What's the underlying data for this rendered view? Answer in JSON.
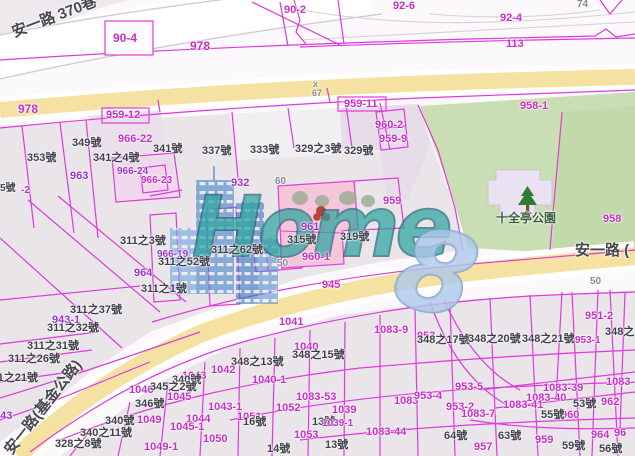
{
  "map": {
    "watermark": {
      "brand": "Home",
      "brand_suffix": "8"
    },
    "park_name": "十全亭公園",
    "roads": [
      "安一路 370巷",
      "安一路 (",
      "安一路(基金公路)"
    ],
    "labels": [
      {
        "t": "安一路 370巷",
        "x": 10,
        "y": 26,
        "c": "road",
        "s": 15,
        "r": -21
      },
      {
        "t": "安一路 (",
        "x": 575,
        "y": 243,
        "c": "road",
        "s": 15
      },
      {
        "t": "安一路(基金公路)",
        "x": 2,
        "y": 448,
        "c": "road",
        "s": 15,
        "r": -52
      },
      {
        "t": "十全亭公園",
        "x": 496,
        "y": 212,
        "c": "green",
        "s": 12
      },
      {
        "t": "90-4",
        "x": 113,
        "y": 32,
        "c": "pink",
        "s": 12
      },
      {
        "t": "978",
        "x": 190,
        "y": 40,
        "c": "pink",
        "s": 12
      },
      {
        "t": "90-2",
        "x": 284,
        "y": 5,
        "c": "pink",
        "s": 11
      },
      {
        "t": "92-6",
        "x": 393,
        "y": 1,
        "c": "pink",
        "s": 11
      },
      {
        "t": "92-4",
        "x": 500,
        "y": 13,
        "c": "pink",
        "s": 11
      },
      {
        "t": "74",
        "x": 577,
        "y": 0,
        "c": "gray",
        "s": 10
      },
      {
        "t": "113",
        "x": 506,
        "y": 39,
        "c": "pink",
        "s": 11
      },
      {
        "t": "978",
        "x": 18,
        "y": 103,
        "c": "pink",
        "s": 12
      },
      {
        "t": "x",
        "x": 313,
        "y": 80,
        "c": "gray",
        "s": 9
      },
      {
        "t": "67",
        "x": 312,
        "y": 89,
        "c": "gray",
        "s": 9
      },
      {
        "t": "959-12",
        "x": 106,
        "y": 110,
        "c": "pink",
        "s": 11
      },
      {
        "t": "966-22",
        "x": 118,
        "y": 134,
        "c": "pink",
        "s": 11
      },
      {
        "t": "349號",
        "x": 72,
        "y": 138,
        "c": "dark",
        "s": 11
      },
      {
        "t": "341號",
        "x": 153,
        "y": 144,
        "c": "dark",
        "s": 11
      },
      {
        "t": "337號",
        "x": 202,
        "y": 146,
        "c": "dark",
        "s": 11
      },
      {
        "t": "353號",
        "x": 27,
        "y": 153,
        "c": "dark",
        "s": 11
      },
      {
        "t": "341之4號",
        "x": 93,
        "y": 153,
        "c": "dark",
        "s": 11
      },
      {
        "t": "963",
        "x": 70,
        "y": 171,
        "c": "purple",
        "s": 11
      },
      {
        "t": "966-24",
        "x": 117,
        "y": 167,
        "c": "purple",
        "s": 10
      },
      {
        "t": "966-23",
        "x": 141,
        "y": 176,
        "c": "pink",
        "s": 10
      },
      {
        "t": "5號",
        "x": 0,
        "y": 184,
        "c": "dark",
        "s": 10
      },
      {
        "t": "-2",
        "x": 21,
        "y": 186,
        "c": "pink",
        "s": 10
      },
      {
        "t": "959-11",
        "x": 344,
        "y": 99,
        "c": "pink",
        "s": 11
      },
      {
        "t": "960-2",
        "x": 375,
        "y": 120,
        "c": "pink",
        "s": 11
      },
      {
        "t": "959-9",
        "x": 379,
        "y": 134,
        "c": "pink",
        "s": 11
      },
      {
        "t": "333號",
        "x": 250,
        "y": 145,
        "c": "dark",
        "s": 11
      },
      {
        "t": "329之3號",
        "x": 295,
        "y": 144,
        "c": "dark",
        "s": 11
      },
      {
        "t": "329號",
        "x": 344,
        "y": 146,
        "c": "dark",
        "s": 11
      },
      {
        "t": "932",
        "x": 231,
        "y": 178,
        "c": "purple",
        "s": 11
      },
      {
        "t": "60",
        "x": 275,
        "y": 177,
        "c": "gray",
        "s": 10
      },
      {
        "t": "959",
        "x": 383,
        "y": 196,
        "c": "pink",
        "s": 11
      },
      {
        "t": "958-1",
        "x": 520,
        "y": 101,
        "c": "pink",
        "s": 11
      },
      {
        "t": "958",
        "x": 603,
        "y": 214,
        "c": "pink",
        "s": 11
      },
      {
        "t": "961",
        "x": 301,
        "y": 222,
        "c": "purple",
        "s": 11
      },
      {
        "t": "315號",
        "x": 287,
        "y": 235,
        "c": "dark",
        "s": 11
      },
      {
        "t": "319號",
        "x": 340,
        "y": 232,
        "c": "dark",
        "s": 11
      },
      {
        "t": "960-1",
        "x": 302,
        "y": 252,
        "c": "pink",
        "s": 11
      },
      {
        "t": "50",
        "x": 277,
        "y": 259,
        "c": "gray",
        "s": 10
      },
      {
        "t": "311之3號",
        "x": 120,
        "y": 236,
        "c": "dark",
        "s": 11
      },
      {
        "t": "311之62號",
        "x": 211,
        "y": 245,
        "c": "dark",
        "s": 11
      },
      {
        "t": "966-19",
        "x": 157,
        "y": 250,
        "c": "purple",
        "s": 10
      },
      {
        "t": "311之52號",
        "x": 158,
        "y": 257,
        "c": "dark",
        "s": 11
      },
      {
        "t": "964",
        "x": 134,
        "y": 268,
        "c": "purple",
        "s": 11
      },
      {
        "t": "311之1號",
        "x": 141,
        "y": 284,
        "c": "dark",
        "s": 11
      },
      {
        "t": "311之37號",
        "x": 70,
        "y": 305,
        "c": "dark",
        "s": 11
      },
      {
        "t": "943-1",
        "x": 52,
        "y": 315,
        "c": "purple",
        "s": 11
      },
      {
        "t": "311之32號",
        "x": 47,
        "y": 323,
        "c": "dark",
        "s": 11
      },
      {
        "t": "311之31號",
        "x": 27,
        "y": 341,
        "c": "dark",
        "s": 11
      },
      {
        "t": "311之26號",
        "x": 8,
        "y": 354,
        "c": "dark",
        "s": 11
      },
      {
        "t": "311之21號",
        "x": -14,
        "y": 373,
        "c": "dark",
        "s": 11
      },
      {
        "t": "945",
        "x": 322,
        "y": 280,
        "c": "pink",
        "s": 11
      },
      {
        "t": "50",
        "x": 590,
        "y": 277,
        "c": "gray",
        "s": 10
      },
      {
        "t": "951-2",
        "x": 585,
        "y": 311,
        "c": "pink",
        "s": 11
      },
      {
        "t": "1041",
        "x": 279,
        "y": 317,
        "c": "pink",
        "s": 11
      },
      {
        "t": "1040",
        "x": 294,
        "y": 342,
        "c": "pink",
        "s": 11
      },
      {
        "t": "348之15號",
        "x": 292,
        "y": 350,
        "c": "dark",
        "s": 11
      },
      {
        "t": "348之13號",
        "x": 231,
        "y": 357,
        "c": "dark",
        "s": 11
      },
      {
        "t": "1042",
        "x": 211,
        "y": 365,
        "c": "pink",
        "s": 11
      },
      {
        "t": "1043",
        "x": 182,
        "y": 371,
        "c": "pink",
        "s": 11
      },
      {
        "t": "340號",
        "x": 172,
        "y": 375,
        "c": "dark",
        "s": 11
      },
      {
        "t": "1040-1",
        "x": 252,
        "y": 375,
        "c": "pink",
        "s": 11
      },
      {
        "t": "1046",
        "x": 129,
        "y": 385,
        "c": "pink",
        "s": 11
      },
      {
        "t": "345之2號",
        "x": 150,
        "y": 382,
        "c": "dark",
        "s": 11
      },
      {
        "t": "1045",
        "x": 167,
        "y": 392,
        "c": "pink",
        "s": 11
      },
      {
        "t": "346號",
        "x": 135,
        "y": 399,
        "c": "dark",
        "s": 11
      },
      {
        "t": "1049",
        "x": 137,
        "y": 415,
        "c": "pink",
        "s": 11
      },
      {
        "t": "340號",
        "x": 105,
        "y": 416,
        "c": "dark",
        "s": 11
      },
      {
        "t": "1044",
        "x": 186,
        "y": 414,
        "c": "pink",
        "s": 11
      },
      {
        "t": "1045-1",
        "x": 170,
        "y": 422,
        "c": "pink",
        "s": 11
      },
      {
        "t": "340之11號",
        "x": 80,
        "y": 428,
        "c": "dark",
        "s": 11
      },
      {
        "t": "328之8號",
        "x": 55,
        "y": 439,
        "c": "dark",
        "s": 11
      },
      {
        "t": "1049-1",
        "x": 144,
        "y": 442,
        "c": "pink",
        "s": 11
      },
      {
        "t": "943",
        "x": -6,
        "y": 411,
        "c": "purple",
        "s": 11
      },
      {
        "t": "1083-53",
        "x": 296,
        "y": 392,
        "c": "pink",
        "s": 11
      },
      {
        "t": "1052",
        "x": 276,
        "y": 403,
        "c": "pink",
        "s": 11
      },
      {
        "t": "1039",
        "x": 332,
        "y": 405,
        "c": "pink",
        "s": 11
      },
      {
        "t": "1043-1",
        "x": 208,
        "y": 402,
        "c": "pink",
        "s": 11
      },
      {
        "t": "1051",
        "x": 237,
        "y": 412,
        "c": "pink",
        "s": 11
      },
      {
        "t": "16號",
        "x": 243,
        "y": 417,
        "c": "dark",
        "s": 11
      },
      {
        "t": "13號",
        "x": 312,
        "y": 417,
        "c": "dark",
        "s": 11
      },
      {
        "t": "1039-1",
        "x": 322,
        "y": 419,
        "c": "pink",
        "s": 10
      },
      {
        "t": "1053",
        "x": 294,
        "y": 430,
        "c": "pink",
        "s": 11
      },
      {
        "t": "1083-44",
        "x": 366,
        "y": 427,
        "c": "pink",
        "s": 11
      },
      {
        "t": "1050",
        "x": 203,
        "y": 434,
        "c": "pink",
        "s": 11
      },
      {
        "t": "14號",
        "x": 267,
        "y": 444,
        "c": "dark",
        "s": 11
      },
      {
        "t": "13號",
        "x": 325,
        "y": 440,
        "c": "dark",
        "s": 11
      },
      {
        "t": "1083",
        "x": 394,
        "y": 396,
        "c": "pink",
        "s": 11
      },
      {
        "t": "1083-9",
        "x": 374,
        "y": 325,
        "c": "pink",
        "s": 11
      },
      {
        "t": "953",
        "x": 417,
        "y": 331,
        "c": "pink",
        "s": 11
      },
      {
        "t": "348之17號",
        "x": 417,
        "y": 335,
        "c": "dark",
        "s": 11
      },
      {
        "t": "348之20號",
        "x": 468,
        "y": 334,
        "c": "dark",
        "s": 11
      },
      {
        "t": "348之21號",
        "x": 522,
        "y": 334,
        "c": "dark",
        "s": 11
      },
      {
        "t": "953-1",
        "x": 575,
        "y": 336,
        "c": "pink",
        "s": 10
      },
      {
        "t": "348之",
        "x": 605,
        "y": 327,
        "c": "dark",
        "s": 11
      },
      {
        "t": "953-5",
        "x": 455,
        "y": 382,
        "c": "pink",
        "s": 11
      },
      {
        "t": "953-4",
        "x": 414,
        "y": 391,
        "c": "pink",
        "s": 11
      },
      {
        "t": "953-2",
        "x": 446,
        "y": 402,
        "c": "pink",
        "s": 11
      },
      {
        "t": "1083-7",
        "x": 461,
        "y": 409,
        "c": "pink",
        "s": 11
      },
      {
        "t": "1083-39",
        "x": 543,
        "y": 383,
        "c": "pink",
        "s": 11
      },
      {
        "t": "1083-40",
        "x": 526,
        "y": 393,
        "c": "pink",
        "s": 11
      },
      {
        "t": "1083-41",
        "x": 503,
        "y": 400,
        "c": "pink",
        "s": 11
      },
      {
        "t": "1083-",
        "x": 606,
        "y": 377,
        "c": "pink",
        "s": 11
      },
      {
        "t": "53號",
        "x": 573,
        "y": 399,
        "c": "dark",
        "s": 11
      },
      {
        "t": "962",
        "x": 601,
        "y": 397,
        "c": "pink",
        "s": 11
      },
      {
        "t": "960",
        "x": 561,
        "y": 410,
        "c": "pink",
        "s": 11
      },
      {
        "t": "55號",
        "x": 541,
        "y": 410,
        "c": "dark",
        "s": 11
      },
      {
        "t": "64號",
        "x": 444,
        "y": 431,
        "c": "dark",
        "s": 11
      },
      {
        "t": "63號",
        "x": 498,
        "y": 431,
        "c": "dark",
        "s": 11
      },
      {
        "t": "957",
        "x": 474,
        "y": 442,
        "c": "pink",
        "s": 11
      },
      {
        "t": "959",
        "x": 535,
        "y": 435,
        "c": "pink",
        "s": 11
      },
      {
        "t": "59號",
        "x": 562,
        "y": 441,
        "c": "dark",
        "s": 11
      },
      {
        "t": "964",
        "x": 591,
        "y": 430,
        "c": "pink",
        "s": 11
      },
      {
        "t": "96",
        "x": 614,
        "y": 428,
        "c": "pink",
        "s": 11
      },
      {
        "t": "56號",
        "x": 599,
        "y": 444,
        "c": "dark",
        "s": 11
      }
    ]
  },
  "palette": {
    "pink": "#C72FC7",
    "purple": "#9C33CE",
    "dark": "#40404A",
    "gray": "#8A8A90",
    "green": "#3E5F3E",
    "road": "#474750",
    "line_pink": "#DE3ADE",
    "road_yellow": "#F5E2A2",
    "park_green": "#CADEB4",
    "parcel_gray": "#E9E5E9",
    "watermark_teal": "#2EA49E",
    "watermark_blue": "#4A85CC",
    "marker_red": "#B23A2A"
  }
}
